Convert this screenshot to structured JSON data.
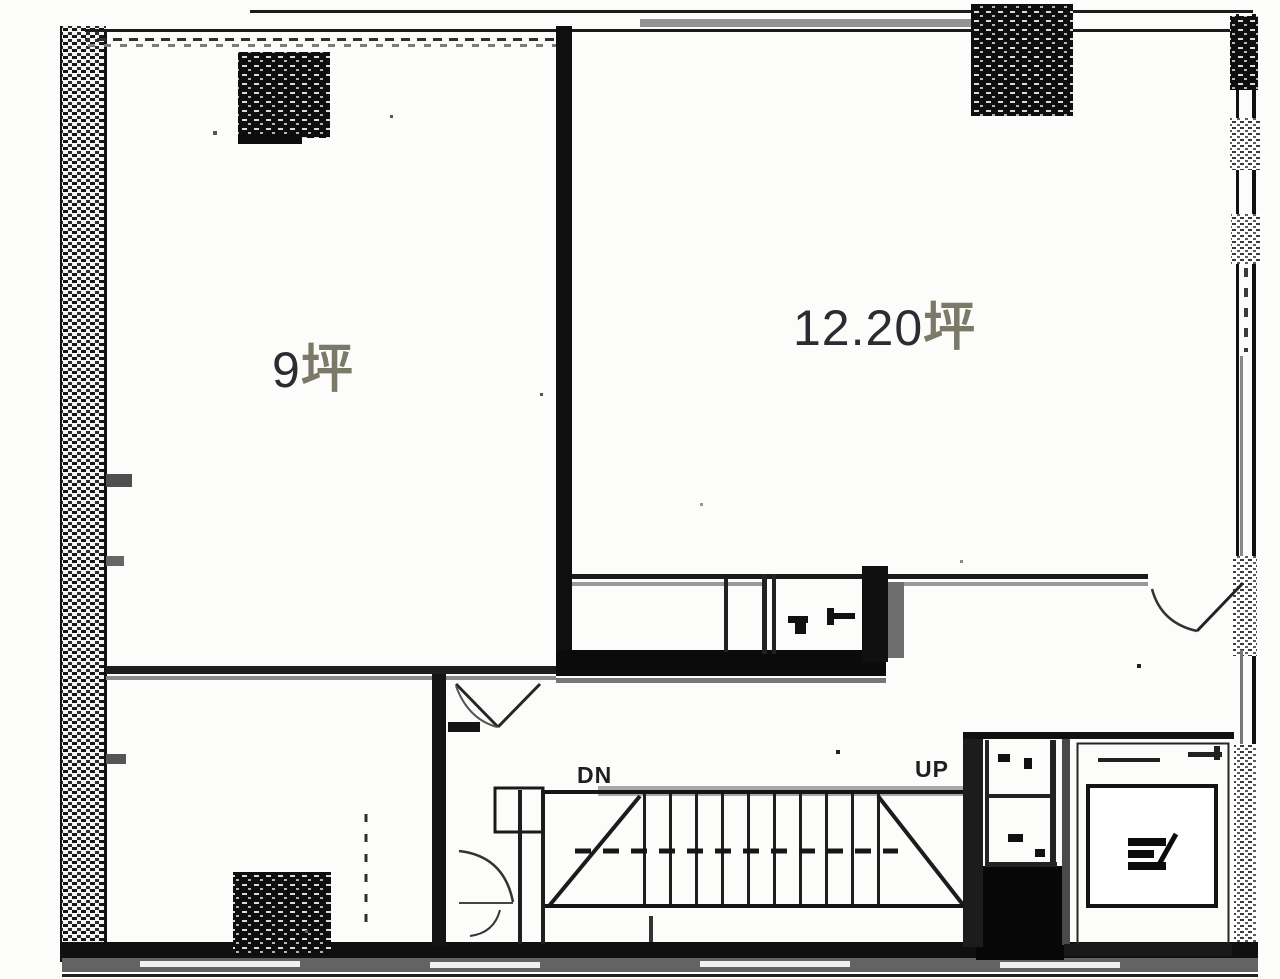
{
  "plan": {
    "rooms": [
      {
        "id": "room-left",
        "area_value": "9",
        "area_unit": "坪"
      },
      {
        "id": "room-right",
        "area_value": "12.20",
        "area_unit": "坪"
      }
    ],
    "stairs": {
      "down_label": "DN",
      "up_label": "UP"
    }
  },
  "colors": {
    "bg": "#fcfcfb",
    "line": "#161616",
    "line_gray": "#8a8a8a",
    "label_number": "#2b2b33",
    "label_unit": "#7b7a68",
    "stair_label": "#1f1f1f"
  }
}
